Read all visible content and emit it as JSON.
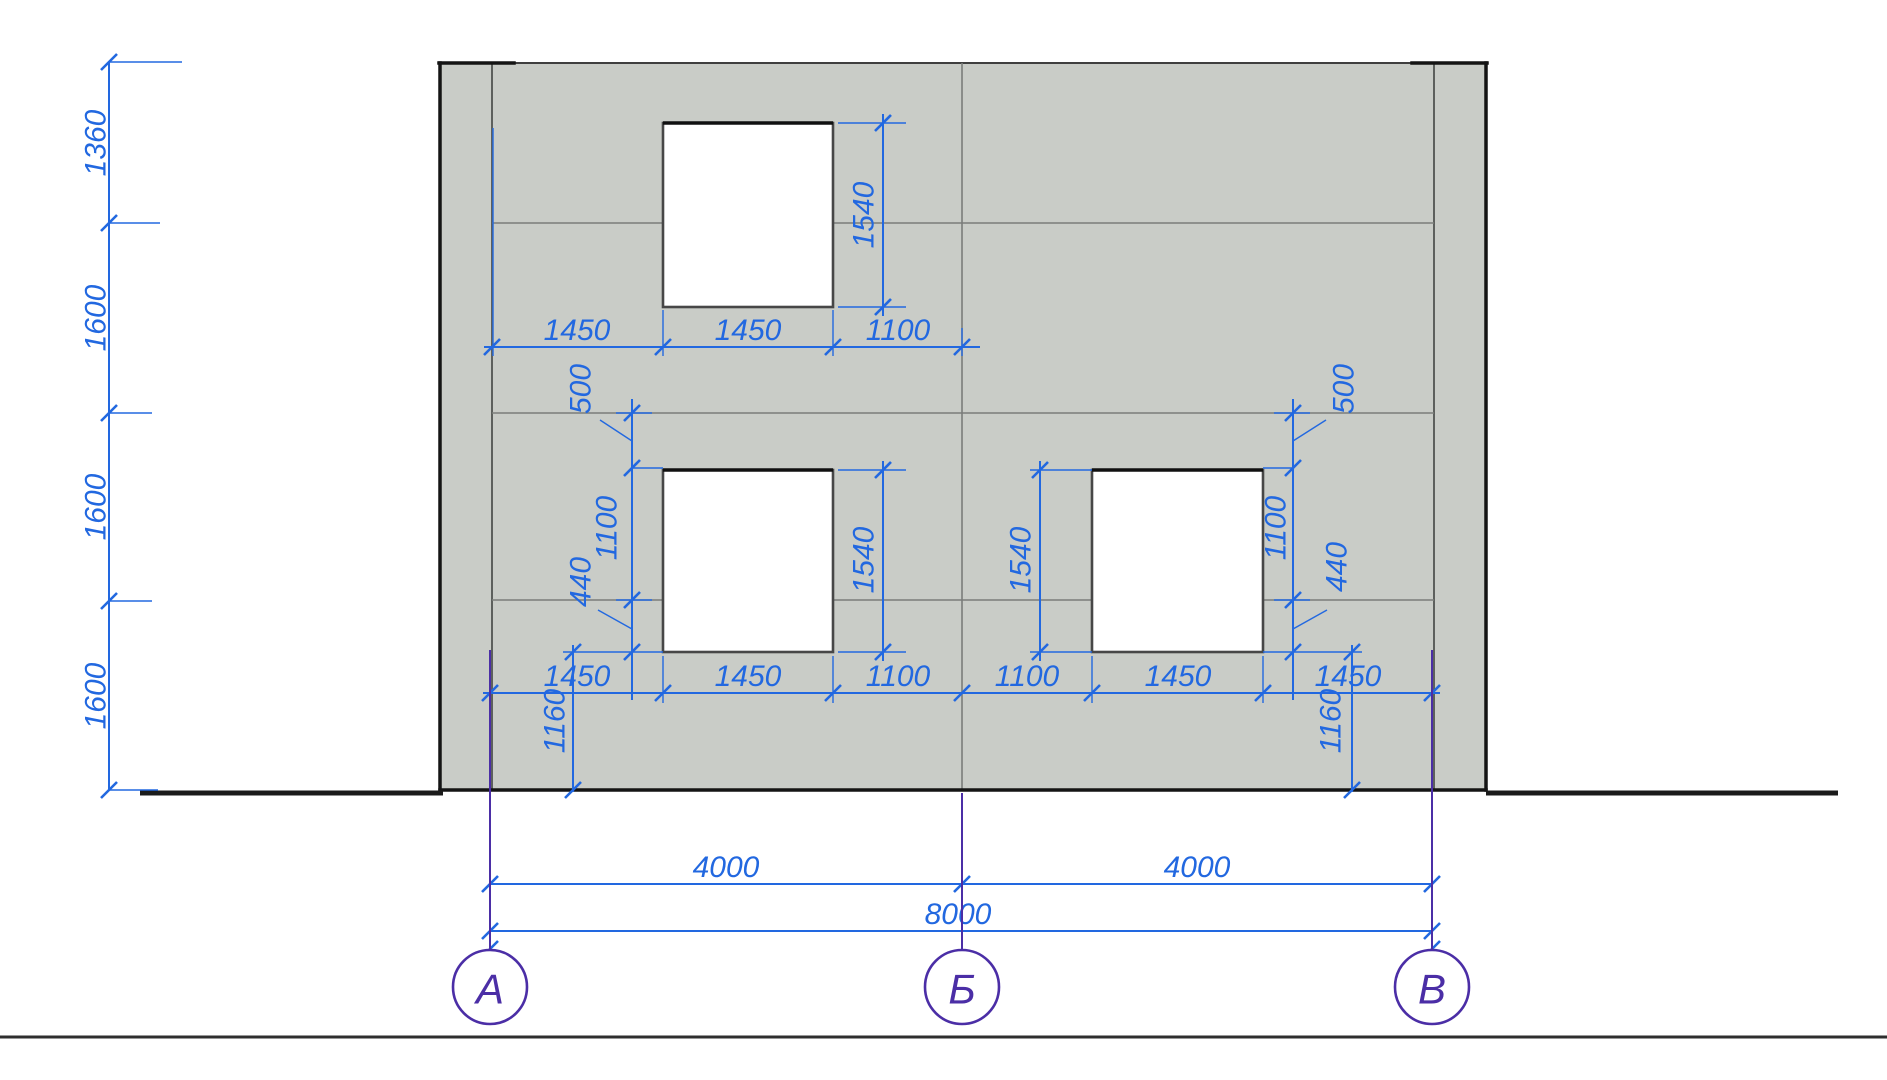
{
  "title": "facade-elevation-drawing",
  "colors": {
    "dimension_blue": "#2268e0",
    "axis_purple": "#4b2ea6",
    "wall_fill": "#c9ccc7",
    "wall_outline": "#3f3f3f",
    "window_fill": "#ffffff"
  },
  "axes": [
    {
      "label": "А"
    },
    {
      "label": "Б"
    },
    {
      "label": "В"
    }
  ],
  "dims": {
    "left_chain": [
      "1360",
      "1600",
      "1600",
      "1600"
    ],
    "upper_chain": [
      "1450",
      "1450",
      "1100"
    ],
    "window_heights": [
      "1540",
      "1540",
      "1540"
    ],
    "left_group": {
      "lintel": "500",
      "head_to_floor": "1100",
      "band": "440",
      "sill_to_ground": "1160"
    },
    "right_group": {
      "lintel": "500",
      "head_to_floor": "1100",
      "band": "440",
      "sill_to_ground": "1160"
    },
    "bottom_chain": [
      "1450",
      "1450",
      "1100",
      "1100",
      "1450",
      "1450"
    ],
    "axis_spans": [
      "4000",
      "4000"
    ],
    "overall_span": "8000"
  }
}
